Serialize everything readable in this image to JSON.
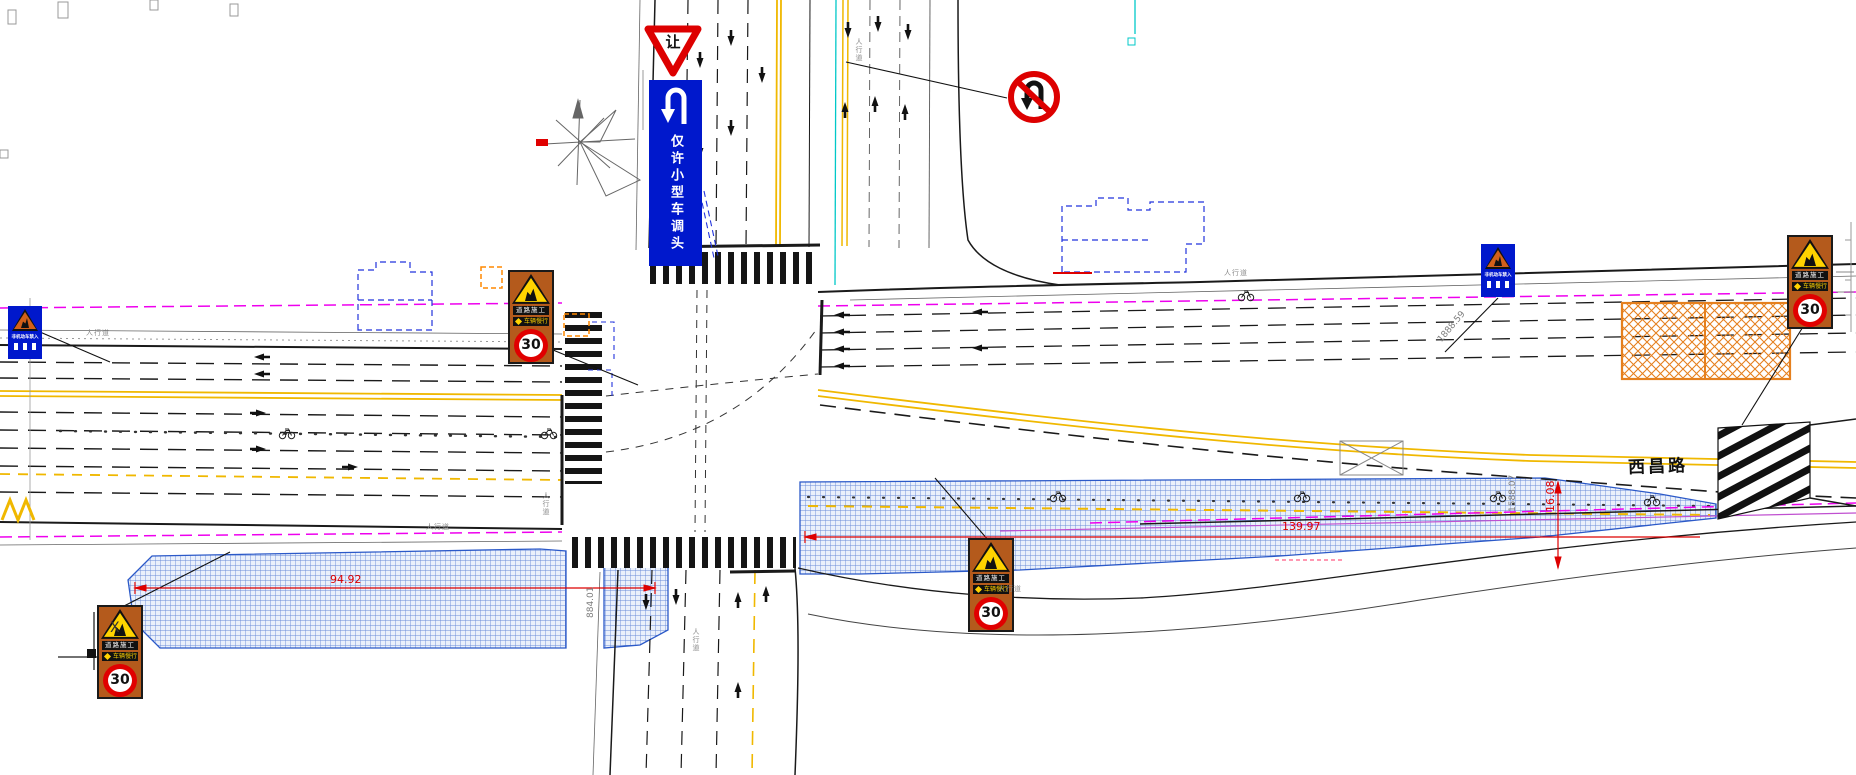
{
  "drawing": {
    "road_name": "西昌路",
    "sidewalk_label": "人行道",
    "axis_label": "X"
  },
  "signs": {
    "yield": {
      "text": "让"
    },
    "small_vehicle_uturn": {
      "icon": "u-turn-arrow",
      "text": "仅许小型车调头"
    },
    "no_uturn": {
      "icon": "no-u-turn-arrow"
    },
    "construction_notice": {
      "icon": "worker-warning-triangle",
      "text": "非机动车禁入"
    },
    "roadwork": {
      "icon": "worker-warning-triangle",
      "title": "道路施工",
      "subtitle": "车辆慢行",
      "speed_limit": "30"
    }
  },
  "dimensions": {
    "west_zone_length_m": "94.92",
    "east_zone_length_m": "139.97",
    "east_zone_width_m": "16.08",
    "station_west": "884.01",
    "station_northeast": "1888.59",
    "station_east": "1588.07"
  },
  "colors": {
    "sign_blue": "#0018cc",
    "sign_orange": "#b45a1c",
    "warning_yellow": "#ffd300",
    "prohibition_red": "#dd0000",
    "zone_hatch_blue": "#5b7fd4",
    "work_hatch_orange": "#e5801e",
    "lane_yellow": "#f0b800",
    "utility_magenta": "#ee00ee",
    "survey_cyan": "#00c8c8"
  }
}
